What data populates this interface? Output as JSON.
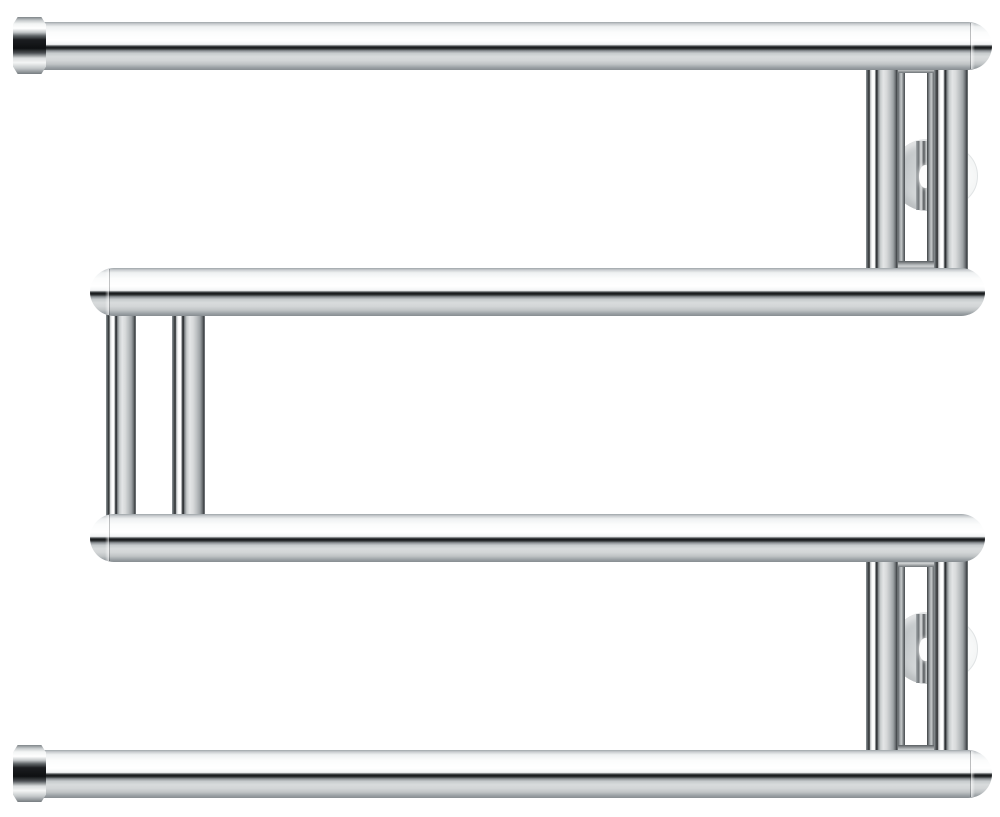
{
  "image": {
    "kind": "product-photo",
    "subject": "chrome serpentine wall-mounted towel rail",
    "background_color": "#ffffff",
    "finish": {
      "chrome_highlight": "#ffffff",
      "chrome_mid": "#c9cdd0",
      "chrome_reflection_dark": "#131517",
      "flange_gray": "#c6cacc",
      "flange_light": "#f1f3f3"
    }
  },
  "scene": {
    "width": 1000,
    "height": 817,
    "elements": [
      {
        "name": "wall-flange-edge-top",
        "type": "circle",
        "cx": 947,
        "cy": 176,
        "r": 31,
        "cls": "flange-edge"
      },
      {
        "name": "wall-flange-top",
        "type": "circle",
        "cx": 927,
        "cy": 175,
        "r": 36,
        "cls": "flange"
      },
      {
        "name": "bracket-stem-top",
        "type": "rect",
        "x": 916,
        "y": 141,
        "w": 18,
        "h": 69,
        "cls": "stem"
      },
      {
        "name": "stem-highlight-top",
        "type": "rect",
        "x": 919,
        "y": 165,
        "w": 13,
        "h": 23,
        "cls": "stem-highlight"
      },
      {
        "name": "wall-flange-edge-bottom",
        "type": "circle",
        "cx": 947,
        "cy": 649,
        "r": 31,
        "cls": "flange-edge"
      },
      {
        "name": "wall-flange-bottom",
        "type": "circle",
        "cx": 927,
        "cy": 648,
        "r": 36,
        "cls": "flange"
      },
      {
        "name": "bracket-stem-bottom",
        "type": "rect",
        "x": 916,
        "y": 614,
        "w": 18,
        "h": 69,
        "cls": "stem"
      },
      {
        "name": "stem-highlight-bottom",
        "type": "rect",
        "x": 919,
        "y": 638,
        "w": 13,
        "h": 23,
        "cls": "stem-highlight"
      },
      {
        "name": "bracket-leg-top-left",
        "type": "rect",
        "x": 897,
        "y": 64,
        "w": 8,
        "h": 206,
        "cls": "bracket-leg"
      },
      {
        "name": "bracket-leg-top-right",
        "type": "rect",
        "x": 927,
        "y": 64,
        "w": 8,
        "h": 206,
        "cls": "bracket-leg"
      },
      {
        "name": "bracket-rail-top-upper",
        "type": "rect",
        "x": 897,
        "y": 64,
        "w": 38,
        "h": 9,
        "cls": "bracket-rail"
      },
      {
        "name": "bracket-rail-top-lower",
        "type": "rect",
        "x": 897,
        "y": 261,
        "w": 38,
        "h": 9,
        "cls": "bracket-rail"
      },
      {
        "name": "bracket-leg-bottom-left",
        "type": "rect",
        "x": 897,
        "y": 558,
        "w": 8,
        "h": 196,
        "cls": "bracket-leg"
      },
      {
        "name": "bracket-leg-bottom-right",
        "type": "rect",
        "x": 927,
        "y": 558,
        "w": 8,
        "h": 196,
        "cls": "bracket-leg"
      },
      {
        "name": "bracket-rail-bottom-upper",
        "type": "rect",
        "x": 897,
        "y": 558,
        "w": 38,
        "h": 9,
        "cls": "bracket-rail"
      },
      {
        "name": "bracket-rail-bottom-lower",
        "type": "rect",
        "x": 897,
        "y": 745,
        "w": 38,
        "h": 9,
        "cls": "bracket-rail"
      },
      {
        "name": "vertical-tube-top-right-front",
        "type": "rect",
        "x": 866,
        "y": 64,
        "w": 32,
        "h": 208,
        "cls": "tube-v"
      },
      {
        "name": "vertical-tube-top-right-rear",
        "type": "rect",
        "x": 934,
        "y": 64,
        "w": 34,
        "h": 208,
        "cls": "tube-v"
      },
      {
        "name": "vertical-tube-left-front",
        "type": "rect",
        "x": 106,
        "y": 310,
        "w": 30,
        "h": 210,
        "cls": "tube-v"
      },
      {
        "name": "vertical-tube-left-rear",
        "type": "rect",
        "x": 172,
        "y": 310,
        "w": 33,
        "h": 210,
        "cls": "tube-v"
      },
      {
        "name": "vertical-tube-bottom-right-front",
        "type": "rect",
        "x": 866,
        "y": 558,
        "w": 32,
        "h": 196,
        "cls": "tube-v"
      },
      {
        "name": "vertical-tube-bottom-right-rear",
        "type": "rect",
        "x": 934,
        "y": 558,
        "w": 34,
        "h": 196,
        "cls": "tube-v"
      },
      {
        "name": "towel-bar-1",
        "type": "rect",
        "x": 40,
        "y": 22,
        "w": 952,
        "h": 48,
        "cls": "tube-h cap-right"
      },
      {
        "name": "towel-bar-2",
        "type": "rect",
        "x": 90,
        "y": 268,
        "w": 895,
        "h": 48,
        "cls": "tube-h cap-left cap-right"
      },
      {
        "name": "towel-bar-3",
        "type": "rect",
        "x": 90,
        "y": 514,
        "w": 895,
        "h": 48,
        "cls": "tube-h cap-left cap-right"
      },
      {
        "name": "towel-bar-4",
        "type": "rect",
        "x": 40,
        "y": 750,
        "w": 952,
        "h": 48,
        "cls": "tube-h cap-right"
      },
      {
        "name": "hex-end-cap-top",
        "type": "rect",
        "x": 13,
        "y": 17,
        "w": 33,
        "h": 57,
        "cls": "hex-cap"
      },
      {
        "name": "hex-end-cap-bottom",
        "type": "rect",
        "x": 13,
        "y": 745,
        "w": 33,
        "h": 57,
        "cls": "hex-cap"
      }
    ]
  }
}
